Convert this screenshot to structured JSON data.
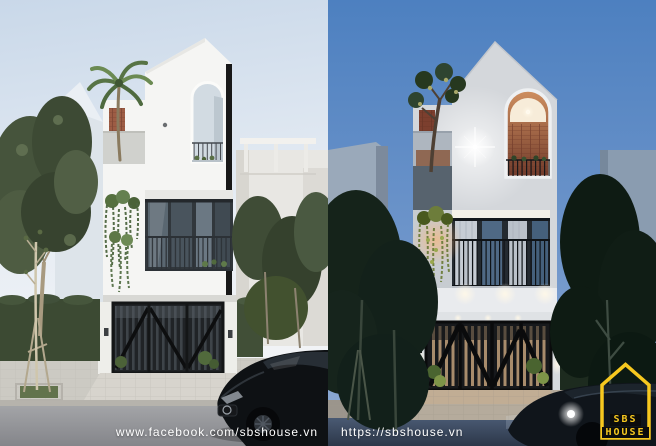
{
  "watermarks": {
    "bottom_left": "www.facebook.com/sbshouse.vn",
    "bottom_right": "https://sbshouse.vn"
  },
  "logo": {
    "line1": "SBS",
    "line2": "HOUSE"
  },
  "colors": {
    "accent_yellow": "#F7C81F",
    "logo_text_bg": "#0c0c0c",
    "watermark_text": "#ffffff",
    "day_sky_top": "#c9d8e9",
    "night_sky_top": "#4d80c0",
    "night_sky_bottom": "#8aa8d3"
  }
}
